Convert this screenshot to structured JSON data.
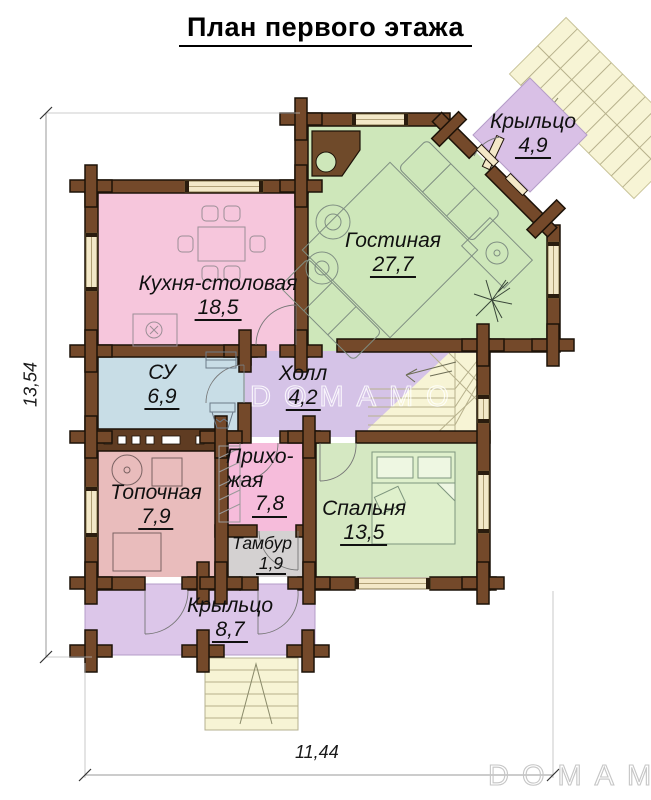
{
  "title": "План первого этажа",
  "rooms": [
    {
      "id": "kitchen",
      "name": "Кухня-столовая",
      "area": "18,5",
      "color": "#f6c6dc"
    },
    {
      "id": "living",
      "name": "Гостиная",
      "area": "27,7",
      "color": "#cee7ba"
    },
    {
      "id": "porch-top",
      "name": "Крыльцо",
      "area": "4,9",
      "color": "#d9c0e6"
    },
    {
      "id": "wc",
      "name": "СУ",
      "area": "6,9",
      "color": "#c8dde6"
    },
    {
      "id": "hall",
      "name": "Холл",
      "area": "4,2",
      "color": "#d5c3e7"
    },
    {
      "id": "boiler",
      "name": "Топочная",
      "area": "7,9",
      "color": "#e9bcbc"
    },
    {
      "id": "entry",
      "name_lines": [
        "Прихо-",
        "жая"
      ],
      "area": "7,8",
      "color": "#f6bcdb"
    },
    {
      "id": "vestibule",
      "name": "Тамбур",
      "area": "1,9",
      "color": "#d4d1d1"
    },
    {
      "id": "bedroom",
      "name": "Спальня",
      "area": "13,5",
      "color": "#d5e8c2"
    },
    {
      "id": "porch-bottom",
      "name": "Крыльцо",
      "area": "8,7",
      "color": "#dcc6e9"
    }
  ],
  "dimensions": {
    "left": "13,54",
    "bottom": "11,44"
  },
  "watermarks": {
    "center": "DOMAMO",
    "corner": "DOMAMO"
  },
  "palette": {
    "wall": "#74492a",
    "wall_outline": "#1c1208",
    "window": "#f3e8c8",
    "stairs": "#f7f4d5",
    "stair_line": "#b7b18c",
    "furniture_line": "#7f8e82",
    "dim_line": "#999999",
    "porch_outline": "#b49cc8"
  }
}
